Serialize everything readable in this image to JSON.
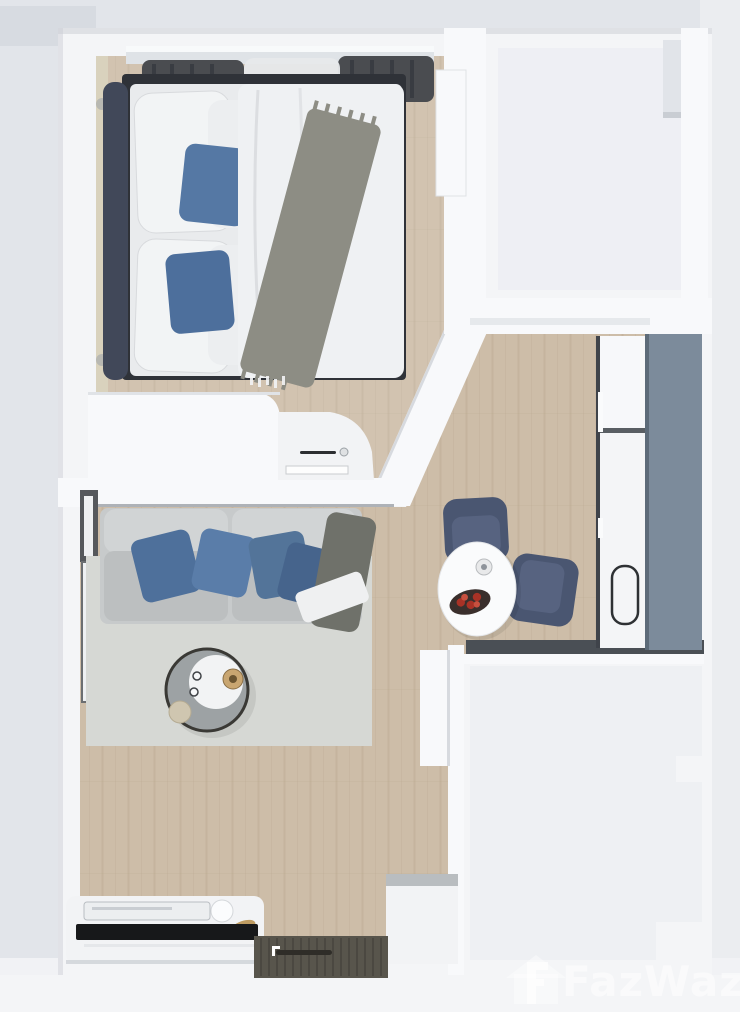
{
  "title": "3D top-view floor plan of a one-bedroom condo unit",
  "watermark": {
    "label": "FazWaz",
    "logo": "house-with-f-logo"
  },
  "palette": {
    "bg": "#e2e5ea",
    "bg_dark": "#d7dbe1",
    "bg_bottom": "#f1f2f5",
    "wall": "#f4f5f7",
    "wall_bright": "#f8f9fb",
    "wall_shadow": "#c9cdd3",
    "room_inner": "#eceef2",
    "floor_wood": "#cdbda8",
    "floor_wood_line": "#b7a48c",
    "rug": "#d6d8d4",
    "headboard_navy": "#414859",
    "bed_frame_dark": "#2f3238",
    "linen": "#e9ebed",
    "duvet": "#eff1f3",
    "pillow_blue": "#5578a4",
    "pillow_blue_dark": "#4d6f9c",
    "throw_gray": "#8d8d84",
    "curtain_dark": "#4a4c50",
    "sheer": "#e7e9eb",
    "window_cream": "#d9d2bd",
    "sofa_gray": "#c7cacb",
    "sofa_seat": "#bcbfc0",
    "sofa_back": "#d1d4d5",
    "sofa_throw_dark": "#6f716a",
    "blanket_white": "#eff0f1",
    "table_white": "#fafbfc",
    "chair_navy": "#4a5671",
    "chair_navy_light": "#576380",
    "bowl_dark": "#3a2f2c",
    "fruit_red": "#a93226",
    "candle_gold": "#c9a671",
    "cup_beige": "#cfc6b0",
    "kitchen_panel": "#7c8b9b",
    "kitchen_panel_edge": "#5d6b79",
    "counter_dark": "#4a4f55",
    "appliance_white": "#f4f5f7",
    "sink_outline": "#2e3134",
    "mat_dark": "#58554c",
    "mat_line": "#49463f",
    "tv_black": "#17181a",
    "watermark_white": "#ffffff"
  },
  "scene": {
    "type": "3d-floorplan-top-view",
    "unit": "one-bedroom condo",
    "rooms": [
      {
        "name": "bedroom",
        "furniture": [
          "double-bed",
          "navy-headboard",
          "blue-accent-pillows",
          "gray-throw-blanket",
          "curtained-window",
          "side-window",
          "wardrobe",
          "vanity-desk",
          "tall-cabinet"
        ]
      },
      {
        "name": "living-room",
        "furniture": [
          "gray-sofa",
          "blue-sofa-pillows",
          "dark-throw",
          "area-rug",
          "round-coffee-table",
          "tv-console",
          "flat-tv",
          "side-window"
        ]
      },
      {
        "name": "kitchen",
        "furniture": [
          "refrigerator",
          "counter-with-sink",
          "slate-cabinet-panel"
        ]
      },
      {
        "name": "dining-area",
        "furniture": [
          "white-oval-table",
          "fruit-bowl",
          "candle",
          "upholstered-chair",
          "upholstered-chair"
        ]
      },
      {
        "name": "bathroom",
        "furniture": []
      },
      {
        "name": "balcony-empty-area",
        "furniture": []
      },
      {
        "name": "entrance",
        "furniture": [
          "doormat",
          "shoe-cabinet"
        ]
      }
    ]
  }
}
